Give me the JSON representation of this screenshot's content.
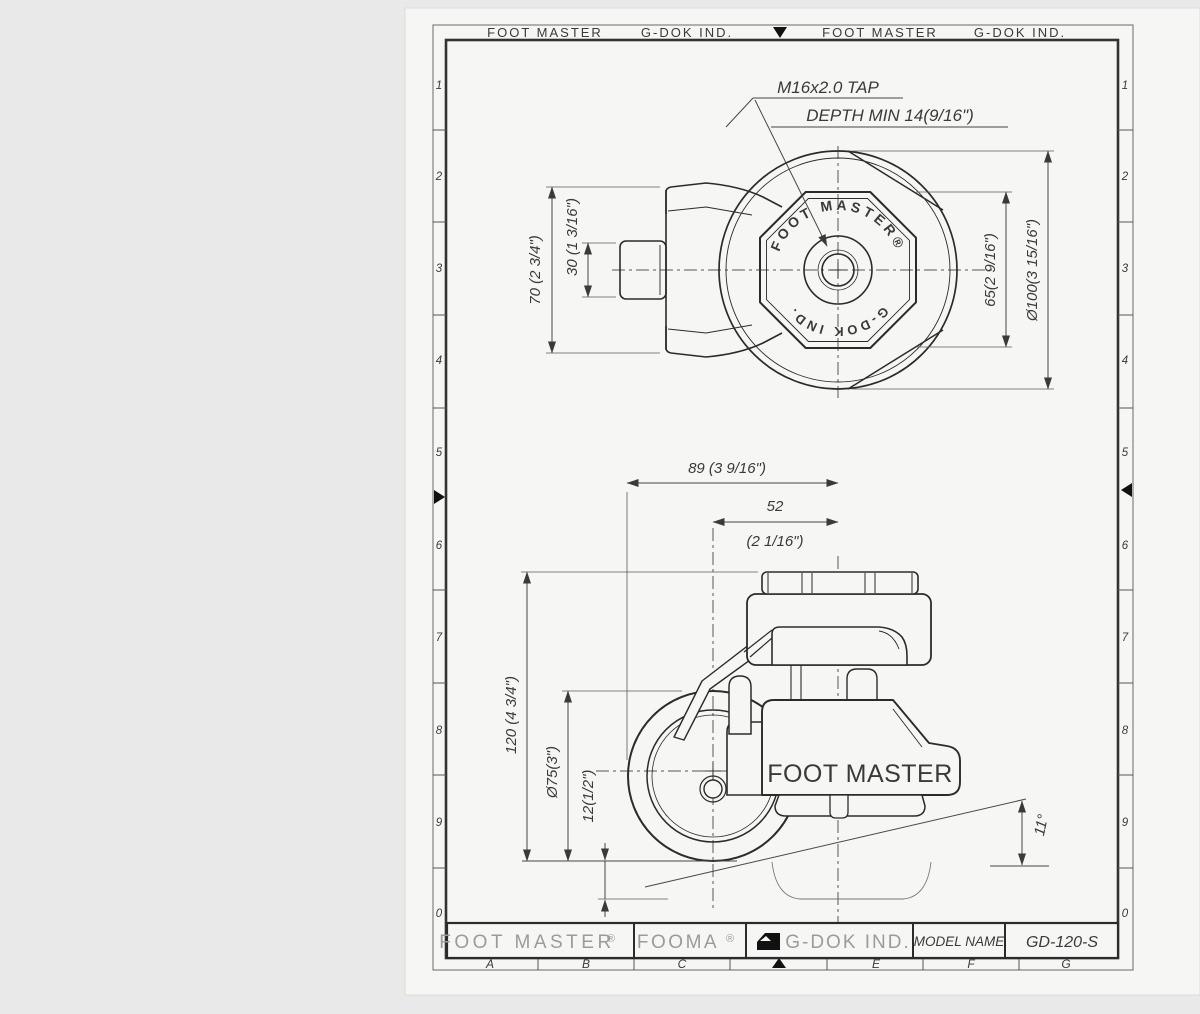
{
  "frame": {
    "header_items": [
      "FOOT MASTER",
      "G-DOK IND.",
      "FOOT MASTER",
      "G-DOK IND."
    ],
    "left_zones": [
      "1",
      "2",
      "3",
      "4",
      "5",
      "6",
      "7",
      "8",
      "9",
      "0"
    ],
    "right_zones": [
      "1",
      "2",
      "3",
      "4",
      "5",
      "6",
      "7",
      "8",
      "9",
      "0"
    ],
    "bottom_zones": [
      "A",
      "B",
      "C",
      "E",
      "F",
      "G"
    ]
  },
  "title_block": {
    "company": "FOOT MASTER",
    "brand": "FOOMA",
    "reg": "®",
    "maker": "G-DOK IND.",
    "model_label": "MODEL NAME",
    "model_value": "GD-120-S"
  },
  "top_view": {
    "callout_line1": "M16x2.0 TAP",
    "callout_line2": "DEPTH MIN 14(9/16\")",
    "ring_text_top": "FOOT MASTER®",
    "ring_text_bottom": "G-DOK IND.",
    "dim_height": "70 (2 3/4\")",
    "dim_tab": "30 (1 3/16\")",
    "dim_flats": "65(2 9/16\")",
    "dim_diameter": "Ø100(3 15/16\")"
  },
  "side_view": {
    "body_label": "FOOT MASTER",
    "dim_width": "89 (3 9/16\")",
    "dim_offset": "52",
    "dim_offset_inch": "(2 1/16\")",
    "dim_height": "120 (4 3/4\")",
    "dim_wheel": "Ø75(3\")",
    "dim_adjust": "12(1/2\")",
    "dim_angle": "11°"
  }
}
